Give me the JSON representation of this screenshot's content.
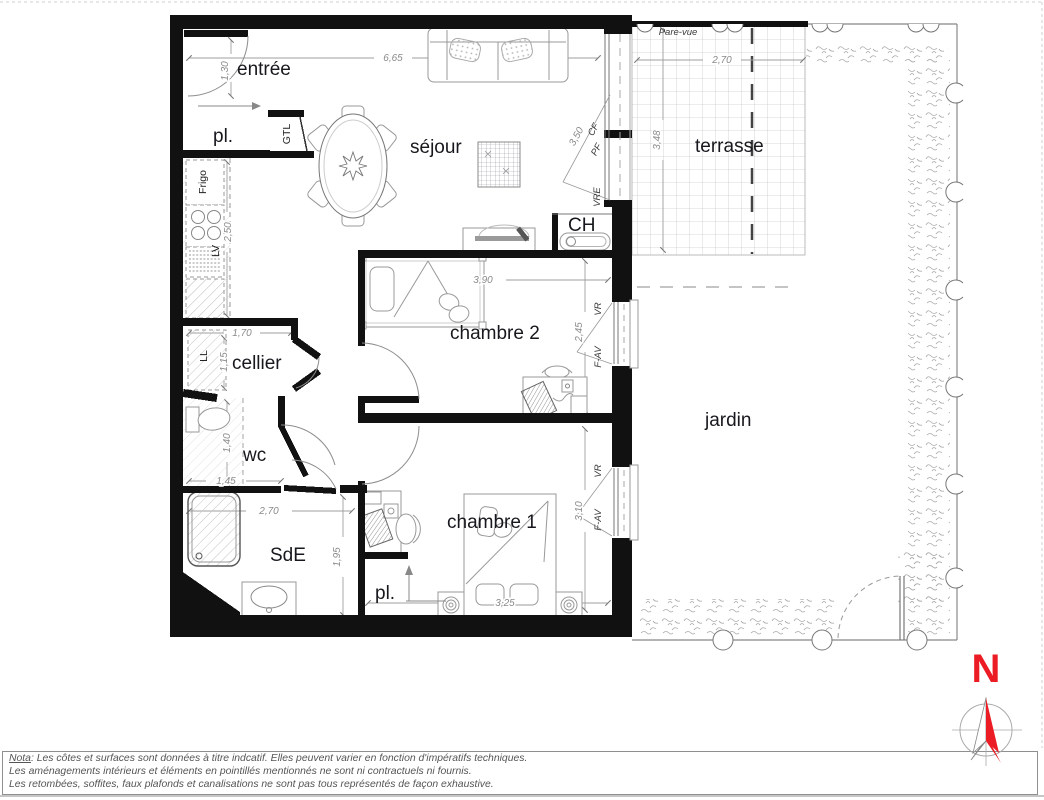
{
  "labels": {
    "entree": "entrée",
    "pl_top": "pl.",
    "gtl": "GTL",
    "frigo": "Frigo",
    "lv": "LV",
    "ll": "LL",
    "sejour": "séjour",
    "cellier": "cellier",
    "wc": "wc",
    "sde": "SdE",
    "pl_bottom": "pl.",
    "chambre1": "chambre 1",
    "chambre2": "chambre 2",
    "ch": "CH",
    "terrasse": "terrasse",
    "jardin": "jardin",
    "pare_vue": "Pare-vue"
  },
  "dims": {
    "entry_width": "1,30",
    "sejour_width": "6,65",
    "terrasse_width": "2,70",
    "terrasse_depth": "3,48",
    "bay_window": "3,50",
    "kitchen_depth": "2,50",
    "cellier_width": "1,70",
    "cellier_depth": "1,15",
    "wc_depth": "1,40",
    "wc_width": "1,45",
    "sde_width": "2,70",
    "sde_depth": "1,95",
    "chambre2_width": "3,90",
    "chambre2_depth": "2,45",
    "chambre1_depth": "3,10",
    "chambre1_width": "3,25"
  },
  "tags": {
    "pf": "PF",
    "cf": "CF",
    "vre": "VRE",
    "vr_chambre2": "VR",
    "fav_chambre2": "F-AV",
    "vr_chambre1": "VR",
    "fav_chambre1": "F-AV"
  },
  "compass": {
    "north": "N"
  },
  "colors": {
    "north_red": "#ec1c24",
    "wall_black": "#111111",
    "dim_gray": "#8a8a8a"
  },
  "footer": {
    "nota": "Nota",
    "line1": ": Les côtes et surfaces sont données à titre indcatif. Elles peuvent varier en fonction d'impératifs techniques.",
    "line2": "Les aménagements intérieurs et éléments en pointillés mentionnés ne sont ni contractuels ni fournis.",
    "line3": "Les retombées, soffites, faux plafonds et canalisations ne sont pas tous représentés de façon exhaustive."
  }
}
